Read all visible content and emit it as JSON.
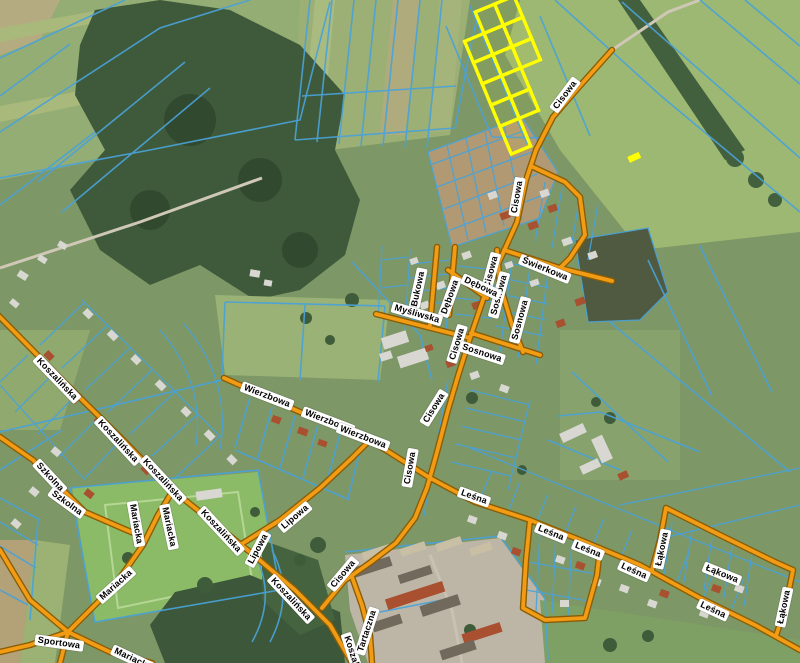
{
  "map": {
    "kind": "cadastral-aerial-map",
    "colors": {
      "parcel_line": "#4aa2d8",
      "road_fill": "#f19c14",
      "road_casing": "#8a5c04",
      "highlight": "#ffff00",
      "label_background": "#ffffff",
      "label_text": "#000000"
    },
    "street_labels": [
      {
        "name": "Cisowa",
        "x": 565,
        "y": 95,
        "rot": -53
      },
      {
        "name": "Cisowa",
        "x": 517,
        "y": 197,
        "rot": -80
      },
      {
        "name": "Cisowa",
        "x": 491,
        "y": 272,
        "rot": -75
      },
      {
        "name": "Cisowa",
        "x": 457,
        "y": 344,
        "rot": -73
      },
      {
        "name": "Cisowa",
        "x": 434,
        "y": 408,
        "rot": -58
      },
      {
        "name": "Cisowa",
        "x": 410,
        "y": 468,
        "rot": -80
      },
      {
        "name": "Cisowa",
        "x": 343,
        "y": 574,
        "rot": -50
      },
      {
        "name": "Świerkowa",
        "x": 545,
        "y": 269,
        "rot": 22
      },
      {
        "name": "Sosnowa",
        "x": 499,
        "y": 295,
        "rot": -75
      },
      {
        "name": "Sosnowa",
        "x": 520,
        "y": 320,
        "rot": -75
      },
      {
        "name": "Sosnowa",
        "x": 482,
        "y": 353,
        "rot": 18
      },
      {
        "name": "Bukowa",
        "x": 418,
        "y": 289,
        "rot": -78
      },
      {
        "name": "Dębowa",
        "x": 450,
        "y": 297,
        "rot": -70
      },
      {
        "name": "Dębowa",
        "x": 481,
        "y": 287,
        "rot": 25
      },
      {
        "name": "Myśliwska",
        "x": 417,
        "y": 314,
        "rot": 16
      },
      {
        "name": "Wierzbowa",
        "x": 267,
        "y": 396,
        "rot": 21
      },
      {
        "name": "Wierzbowa",
        "x": 328,
        "y": 421,
        "rot": 21
      },
      {
        "name": "Wierzbowa",
        "x": 363,
        "y": 437,
        "rot": 21
      },
      {
        "name": "Koszalińska",
        "x": 57,
        "y": 379,
        "rot": 46
      },
      {
        "name": "Koszalińska",
        "x": 118,
        "y": 441,
        "rot": 47
      },
      {
        "name": "Koszalińska",
        "x": 163,
        "y": 480,
        "rot": 47
      },
      {
        "name": "Koszalińska",
        "x": 221,
        "y": 531,
        "rot": 47
      },
      {
        "name": "Koszalińska",
        "x": 291,
        "y": 599,
        "rot": 47
      },
      {
        "name": "Koszalińska",
        "x": 355,
        "y": 662,
        "rot": 72
      },
      {
        "name": "Szkolna",
        "x": 50,
        "y": 477,
        "rot": 47
      },
      {
        "name": "Szkolna",
        "x": 67,
        "y": 503,
        "rot": 36
      },
      {
        "name": "Mariacka",
        "x": 136,
        "y": 524,
        "rot": 80
      },
      {
        "name": "Mariacka",
        "x": 169,
        "y": 527,
        "rot": 78
      },
      {
        "name": "Mariacka",
        "x": 116,
        "y": 585,
        "rot": -42
      },
      {
        "name": "Mariacka",
        "x": 133,
        "y": 659,
        "rot": 25
      },
      {
        "name": "Sportowa",
        "x": 59,
        "y": 643,
        "rot": 8
      },
      {
        "name": "Lipowa",
        "x": 295,
        "y": 517,
        "rot": -40
      },
      {
        "name": "Lipowa",
        "x": 258,
        "y": 549,
        "rot": -62
      },
      {
        "name": "Tartaczna",
        "x": 367,
        "y": 631,
        "rot": -72
      },
      {
        "name": "Leśna",
        "x": 474,
        "y": 497,
        "rot": 20
      },
      {
        "name": "Leśna",
        "x": 551,
        "y": 533,
        "rot": 22
      },
      {
        "name": "Leśna",
        "x": 588,
        "y": 550,
        "rot": 22
      },
      {
        "name": "Leśna",
        "x": 634,
        "y": 571,
        "rot": 24
      },
      {
        "name": "Leśna",
        "x": 713,
        "y": 610,
        "rot": 25
      },
      {
        "name": "Łąkowa",
        "x": 662,
        "y": 549,
        "rot": -78
      },
      {
        "name": "Łąkowa",
        "x": 722,
        "y": 574,
        "rot": 22
      },
      {
        "name": "Łąkowa",
        "x": 784,
        "y": 607,
        "rot": -78
      }
    ],
    "highlighted_parcels": {
      "outline_color": "#ffff00",
      "cell_count": 13
    }
  }
}
